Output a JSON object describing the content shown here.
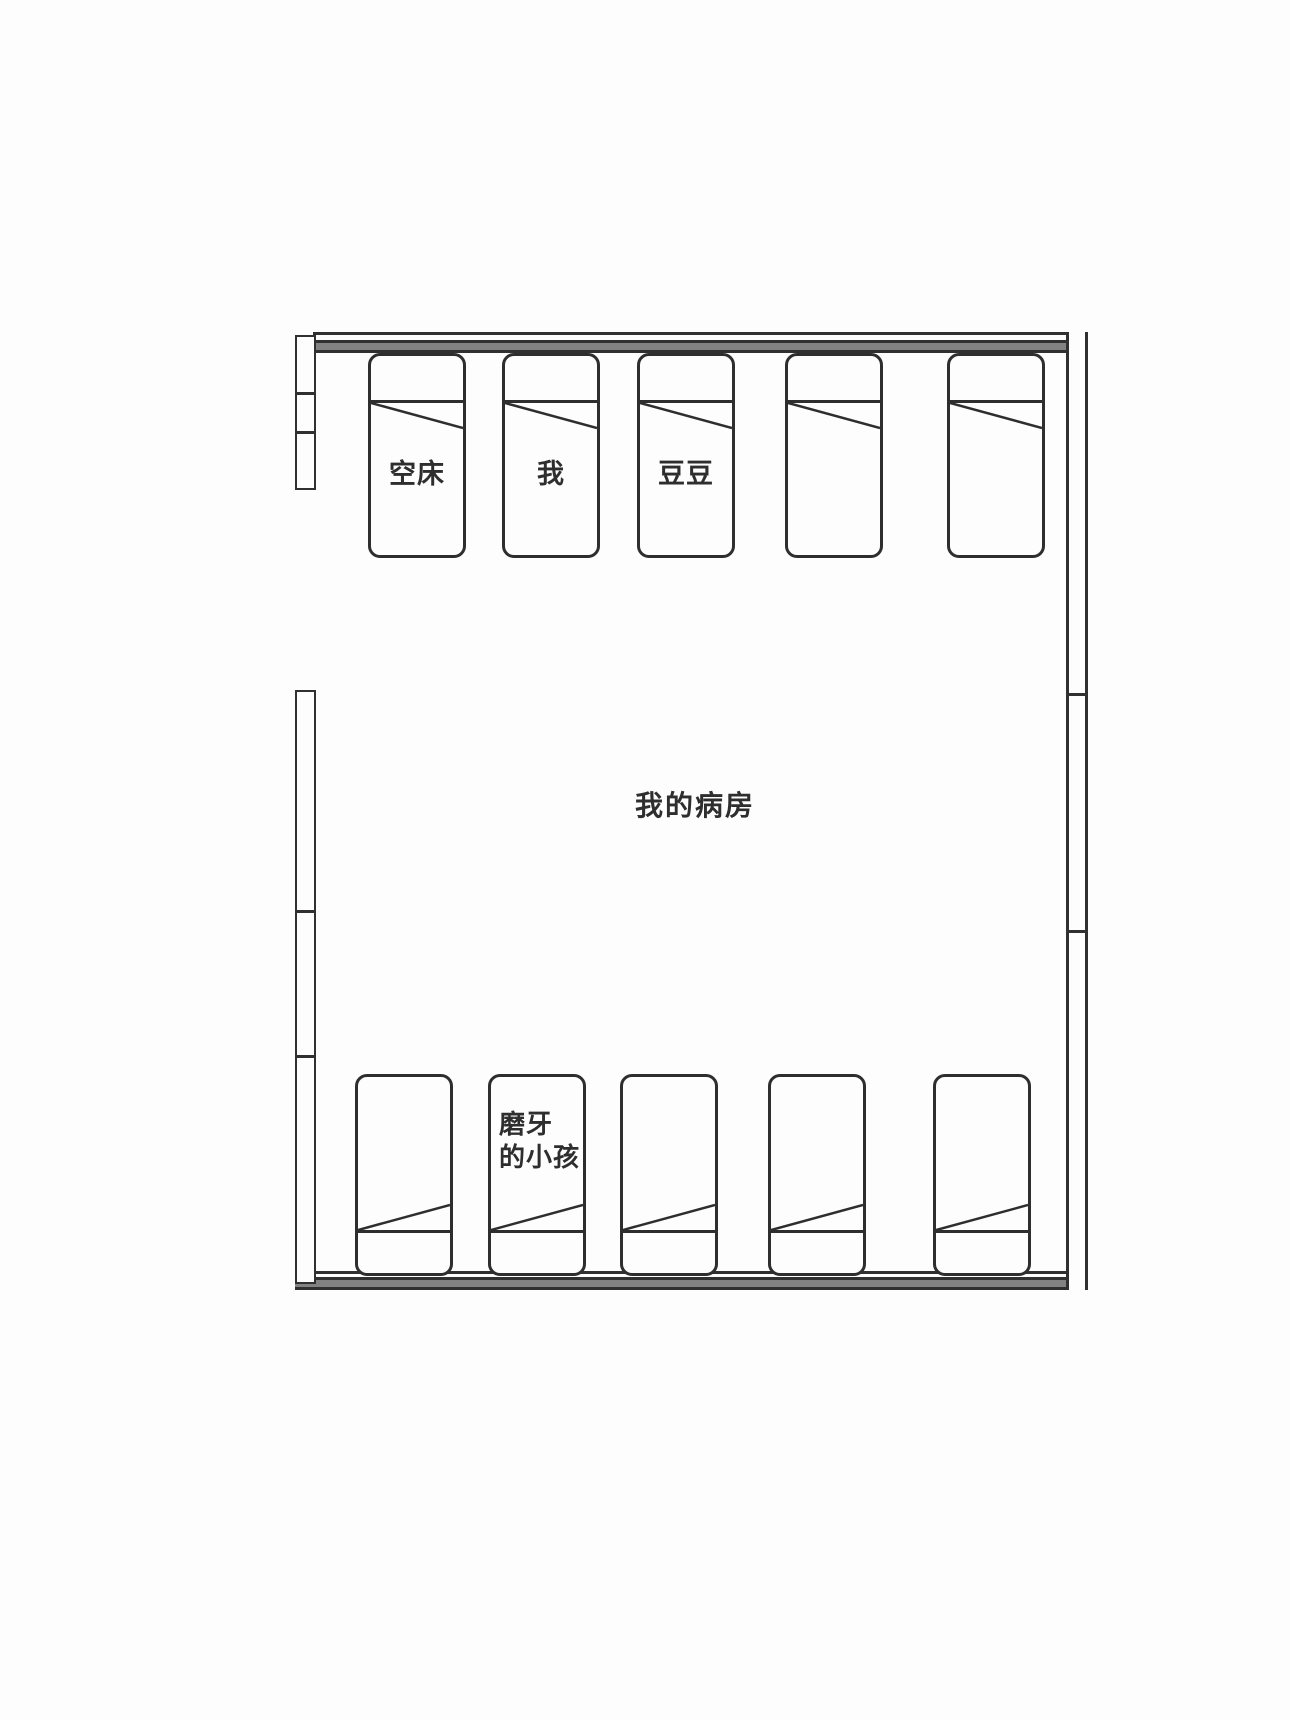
{
  "room": {
    "title": "我的病房"
  },
  "beds": {
    "top_row": [
      {
        "label": "空床"
      },
      {
        "label": "我"
      },
      {
        "label": "豆豆"
      },
      {
        "label": ""
      },
      {
        "label": ""
      }
    ],
    "bottom_row": [
      {
        "label": ""
      },
      {
        "label": "磨牙的小孩",
        "label_lines": [
          "磨牙",
          "的小孩"
        ]
      },
      {
        "label": ""
      },
      {
        "label": ""
      },
      {
        "label": ""
      }
    ]
  },
  "colors": {
    "line": "#303030",
    "wall_fill": "#828282",
    "background": "#fdfdfd",
    "text": "#2e2e2e"
  }
}
